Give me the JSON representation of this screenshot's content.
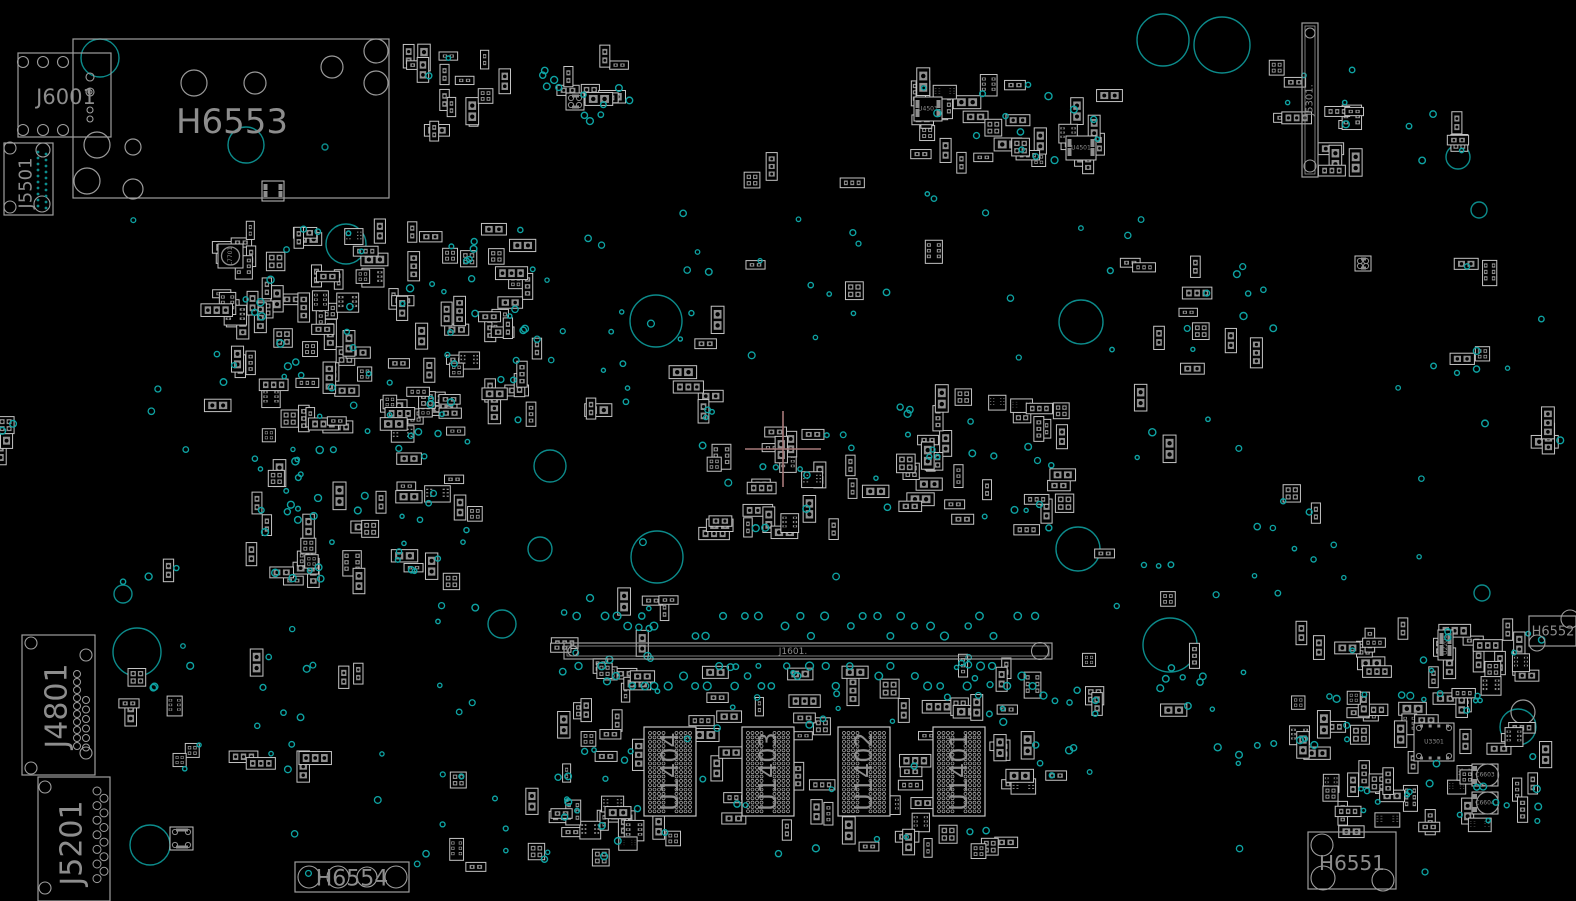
{
  "colors": {
    "background": "#000000",
    "silk_text": "#8d8d8d",
    "box_outline": "#9e9e9e",
    "part_outline": "#c4c4c4",
    "pad_fill": "#8f8f8f",
    "via": "#0ea3a3",
    "big_circle": "#0c8b8b",
    "gray_circle": "#9a9a9a",
    "ball": "#b0b0b0",
    "crosshair": "#a87a7a"
  },
  "board": {
    "width": 1576,
    "height": 901,
    "majors": [
      {
        "id": "H6553",
        "label": "H6553",
        "x": 73,
        "y": 39,
        "w": 316,
        "h": 159,
        "font": 34,
        "lx": 232,
        "ly": 122,
        "rot": 0
      },
      {
        "id": "J6001",
        "label": "J6001",
        "x": 18,
        "y": 53,
        "w": 93,
        "h": 84,
        "font": 21,
        "lx": 66,
        "ly": 97,
        "rot": 0,
        "pins": [
          [
            23,
            62,
            5.5
          ],
          [
            43,
            62,
            5.5
          ],
          [
            63,
            62,
            5.5
          ],
          [
            23,
            130,
            5.5
          ],
          [
            43,
            130,
            5.5
          ],
          [
            63,
            130,
            5.5
          ],
          [
            90,
            77,
            4
          ],
          [
            90,
            92,
            4
          ],
          [
            90,
            92,
            2
          ],
          [
            90,
            110,
            3
          ],
          [
            90,
            119,
            3
          ]
        ]
      },
      {
        "id": "J5501",
        "label": "J5501",
        "x": 4,
        "y": 143,
        "w": 49,
        "h": 72,
        "font": 18,
        "lx": 26,
        "ly": 183,
        "rot": -90,
        "pins": [
          [
            10,
            148,
            6
          ],
          [
            43,
            150,
            7
          ],
          [
            10,
            207,
            6
          ],
          [
            42,
            204,
            8
          ]
        ],
        "dotcols": [
          {
            "x": 38,
            "y0": 152,
            "n": 10,
            "dy": 6
          },
          {
            "x": 46,
            "y0": 154,
            "n": 10,
            "dy": 6
          }
        ]
      },
      {
        "id": "J4801",
        "label": "J4801",
        "x": 22,
        "y": 635,
        "w": 73,
        "h": 140,
        "font": 30,
        "lx": 57,
        "ly": 706,
        "rot": -90,
        "pins": [
          [
            31,
            643,
            6
          ],
          [
            86,
            655,
            6
          ],
          [
            31,
            768,
            6
          ],
          [
            86,
            753,
            6
          ]
        ],
        "pincols": [
          {
            "x": 77,
            "y0": 674,
            "n": 10,
            "dy": 8,
            "r": 3.5
          },
          {
            "x": 86,
            "y0": 700,
            "n": 6,
            "dy": 9.5,
            "r": 3.5
          }
        ]
      },
      {
        "id": "J5201",
        "label": "J5201",
        "x": 38,
        "y": 777,
        "w": 72,
        "h": 124,
        "font": 30,
        "lx": 72,
        "ly": 843,
        "rot": -90,
        "pins": [
          [
            45,
            787,
            6
          ],
          [
            45,
            888,
            6
          ]
        ],
        "zigzag": {
          "x1": 97,
          "x2": 104,
          "y0": 791,
          "n": 13,
          "dy": 7.3,
          "r": 4
        }
      },
      {
        "id": "H6554",
        "label": "H6554",
        "x": 295,
        "y": 862,
        "w": 114,
        "h": 30,
        "font": 22,
        "lx": 352,
        "ly": 879,
        "rot": 0,
        "pins": [
          [
            309,
            877,
            11
          ],
          [
            338,
            877,
            11
          ],
          [
            367,
            877,
            10
          ],
          [
            396,
            877,
            11
          ]
        ]
      },
      {
        "id": "H6551",
        "label": "H6551",
        "x": 1308,
        "y": 832,
        "w": 88,
        "h": 57,
        "font": 20,
        "lx": 1352,
        "ly": 863,
        "rot": 0,
        "pins": [
          [
            1322,
            845,
            11
          ],
          [
            1323,
            878,
            12
          ],
          [
            1383,
            880,
            11
          ]
        ]
      },
      {
        "id": "H6552",
        "label": "H6552",
        "x": 1529,
        "y": 616,
        "w": 47,
        "h": 30,
        "font": 13,
        "lx": 1553,
        "ly": 632,
        "rot": 0,
        "pins": [
          [
            1537,
            643,
            8
          ],
          [
            1570,
            619,
            9
          ]
        ]
      },
      {
        "id": "J5301",
        "label": "J5301.",
        "x": 1302,
        "y": 23,
        "w": 16,
        "h": 154,
        "font": 10,
        "lx": 1310,
        "ly": 100,
        "rot": -90,
        "inner": true,
        "pins": [
          [
            1310,
            33,
            5
          ],
          [
            1310,
            166,
            6
          ]
        ]
      },
      {
        "id": "J1601",
        "label": "J1601.",
        "x": 564,
        "y": 643,
        "w": 488,
        "h": 16,
        "font": 9,
        "lx": 793,
        "ly": 652,
        "rot": 0,
        "slot": true,
        "pins": [
          [
            573,
            651,
            5
          ],
          [
            1040,
            651,
            8.5
          ]
        ]
      }
    ],
    "chips": {
      "lefts": [
        644,
        742,
        838,
        933
      ],
      "top": 727,
      "w": 52,
      "h": 89,
      "font": 24,
      "labels": [
        "U1404",
        "U1403",
        "U1402",
        "U1401"
      ]
    },
    "named_parts": [
      {
        "label": "U4503",
        "x": 914,
        "y": 97,
        "w": 28,
        "h": 24,
        "rot": 0,
        "type": "ic"
      },
      {
        "label": "U4501",
        "x": 1066,
        "y": 136,
        "w": 30,
        "h": 24,
        "rot": 0,
        "type": "ic"
      },
      {
        "label": "U2201",
        "x": 1438,
        "y": 630,
        "w": 15,
        "h": 30,
        "rot": -90,
        "type": "ic"
      },
      {
        "label": "U3301",
        "x": 1414,
        "y": 723,
        "w": 40,
        "h": 38,
        "rot": 0,
        "type": "qfn"
      },
      {
        "label": "C6603",
        "x": 1472,
        "y": 764,
        "w": 26,
        "h": 22,
        "rot": 0,
        "type": "cap"
      },
      {
        "label": "C6604",
        "x": 1472,
        "y": 792,
        "w": 26,
        "h": 22,
        "rot": 0,
        "type": "cap"
      },
      {
        "label": "L7701",
        "x": 218,
        "y": 244,
        "w": 25,
        "h": 24,
        "rot": -90,
        "type": "coil"
      },
      {
        "label": "",
        "x": 262,
        "y": 181,
        "w": 22,
        "h": 20,
        "rot": 0,
        "type": "ic"
      },
      {
        "label": "",
        "x": 170,
        "y": 827,
        "w": 23,
        "h": 23,
        "rot": 0,
        "type": "qfn"
      },
      {
        "label": "",
        "x": 566,
        "y": 93,
        "w": 18,
        "h": 17,
        "rot": 0,
        "type": "qfn"
      },
      {
        "label": "",
        "x": 1355,
        "y": 256,
        "w": 16,
        "h": 15,
        "rot": 0,
        "type": "qfn"
      }
    ],
    "crosshair": {
      "x": 783,
      "y": 449,
      "arm": 38
    },
    "big_circles": [
      [
        100,
        58,
        19
      ],
      [
        246,
        145,
        18
      ],
      [
        1163,
        40,
        26
      ],
      [
        1222,
        45,
        28
      ],
      [
        1458,
        157,
        12
      ],
      [
        1479,
        210,
        8
      ],
      [
        346,
        244,
        20
      ],
      [
        656,
        321,
        26
      ],
      [
        1081,
        322,
        22
      ],
      [
        550,
        466,
        16
      ],
      [
        540,
        549,
        12
      ],
      [
        657,
        557,
        26
      ],
      [
        1078,
        549,
        22
      ],
      [
        123,
        594,
        9
      ],
      [
        502,
        624,
        14
      ],
      [
        1482,
        593,
        8
      ],
      [
        137,
        652,
        24
      ],
      [
        1170,
        645,
        27
      ],
      [
        150,
        845,
        20
      ],
      [
        1518,
        727,
        18
      ],
      [
        1437,
        743,
        13
      ],
      [
        325,
        147,
        3
      ]
    ],
    "gray_circles": [
      [
        194,
        83,
        13
      ],
      [
        255,
        83,
        11
      ],
      [
        332,
        67,
        11
      ],
      [
        376,
        51,
        12
      ],
      [
        376,
        83,
        12
      ],
      [
        97,
        145,
        13
      ],
      [
        133,
        147,
        8
      ],
      [
        87,
        181,
        13
      ],
      [
        133,
        189,
        10
      ],
      [
        1523,
        712,
        12
      ]
    ],
    "clusters": [
      {
        "id": "top-left-bank",
        "x": 408,
        "y": 48,
        "w": 100,
        "h": 90,
        "parts": 16,
        "vias": 2
      },
      {
        "id": "top-center",
        "x": 538,
        "y": 52,
        "w": 92,
        "h": 72,
        "parts": 8,
        "vias": 12
      },
      {
        "id": "top-right-bank",
        "x": 905,
        "y": 80,
        "w": 205,
        "h": 92,
        "parts": 32,
        "vias": 14
      },
      {
        "id": "right-edge-top-a",
        "x": 1262,
        "y": 58,
        "w": 42,
        "h": 60,
        "parts": 4,
        "vias": 2
      },
      {
        "id": "right-edge-top-b",
        "x": 1330,
        "y": 62,
        "w": 30,
        "h": 118,
        "parts": 8,
        "vias": 3
      },
      {
        "id": "left-main",
        "x": 214,
        "y": 228,
        "w": 324,
        "h": 208,
        "parts": 112,
        "vias": 55
      },
      {
        "id": "left-lower",
        "x": 250,
        "y": 448,
        "w": 190,
        "h": 135,
        "parts": 24,
        "vias": 34
      },
      {
        "id": "center-main",
        "x": 700,
        "y": 396,
        "w": 368,
        "h": 142,
        "parts": 58,
        "vias": 30
      },
      {
        "id": "center-right-sparse",
        "x": 1100,
        "y": 255,
        "w": 175,
        "h": 225,
        "parts": 12,
        "vias": 12
      },
      {
        "id": "slot-left",
        "x": 552,
        "y": 598,
        "w": 118,
        "h": 100,
        "parts": 14,
        "vias": 10
      },
      {
        "id": "slot-below",
        "x": 690,
        "y": 662,
        "w": 370,
        "h": 36,
        "parts": 10,
        "vias": 10
      },
      {
        "id": "ram-gap-1",
        "x": 698,
        "y": 712,
        "w": 42,
        "h": 112,
        "parts": 7,
        "vias": 2
      },
      {
        "id": "ram-gap-2",
        "x": 796,
        "y": 712,
        "w": 40,
        "h": 112,
        "parts": 7,
        "vias": 2
      },
      {
        "id": "ram-gap-3",
        "x": 892,
        "y": 712,
        "w": 39,
        "h": 112,
        "parts": 7,
        "vias": 2
      },
      {
        "id": "ram-gap-4",
        "x": 987,
        "y": 712,
        "w": 45,
        "h": 112,
        "parts": 7,
        "vias": 2
      },
      {
        "id": "ram-top-row",
        "x": 640,
        "y": 698,
        "w": 372,
        "h": 15,
        "parts": 9,
        "vias": 2
      },
      {
        "id": "ram-bottom-row",
        "x": 640,
        "y": 826,
        "w": 380,
        "h": 32,
        "parts": 12,
        "vias": 6
      },
      {
        "id": "ram-left-bank",
        "x": 552,
        "y": 700,
        "w": 90,
        "h": 158,
        "parts": 22,
        "vias": 12
      },
      {
        "id": "bottom-left-sparse",
        "x": 112,
        "y": 655,
        "w": 195,
        "h": 115,
        "parts": 10,
        "vias": 12
      },
      {
        "id": "bottom-right-main",
        "x": 1298,
        "y": 628,
        "w": 248,
        "h": 204,
        "parts": 74,
        "vias": 40
      },
      {
        "id": "mid-sparse-a",
        "x": 580,
        "y": 328,
        "w": 148,
        "h": 108,
        "parts": 5,
        "vias": 6
      },
      {
        "id": "mid-sparse-b",
        "x": 680,
        "y": 162,
        "w": 288,
        "h": 158,
        "parts": 7,
        "vias": 10
      },
      {
        "id": "mid-sparse-c",
        "x": 405,
        "y": 440,
        "w": 75,
        "h": 200,
        "parts": 6,
        "vias": 8
      },
      {
        "id": "bottom-center-sparse",
        "x": 420,
        "y": 772,
        "w": 150,
        "h": 115,
        "parts": 6,
        "vias": 10
      },
      {
        "id": "right-top-sparse",
        "x": 1380,
        "y": 82,
        "w": 92,
        "h": 86,
        "parts": 3,
        "vias": 4
      },
      {
        "id": "right-mid-sparse",
        "x": 1430,
        "y": 252,
        "w": 128,
        "h": 198,
        "parts": 5,
        "vias": 6
      },
      {
        "id": "right-edge-pair",
        "x": 1545,
        "y": 420,
        "w": 31,
        "h": 28,
        "parts": 2,
        "vias": 1
      },
      {
        "id": "center-low-sparse",
        "x": 1095,
        "y": 552,
        "w": 80,
        "h": 68,
        "parts": 2,
        "vias": 4
      },
      {
        "id": "left-edge-mid",
        "x": 0,
        "y": 408,
        "w": 16,
        "h": 58,
        "parts": 3,
        "vias": 2
      },
      {
        "id": "left-mid-sparse",
        "x": 100,
        "y": 560,
        "w": 85,
        "h": 58,
        "parts": 1,
        "vias": 3
      },
      {
        "id": "right-center-sparse",
        "x": 1240,
        "y": 482,
        "w": 78,
        "h": 98,
        "parts": 2,
        "vias": 5
      },
      {
        "id": "slot-right-below",
        "x": 1040,
        "y": 658,
        "w": 70,
        "h": 56,
        "parts": 3,
        "vias": 6
      },
      {
        "id": "circle-right-vias",
        "x": 1160,
        "y": 642,
        "w": 100,
        "h": 76,
        "parts": 2,
        "vias": 8
      },
      {
        "id": "bottom-mid-vias",
        "x": 1200,
        "y": 730,
        "w": 80,
        "h": 40,
        "parts": 0,
        "vias": 5
      },
      {
        "id": "ram-right-vias",
        "x": 1030,
        "y": 730,
        "w": 50,
        "h": 60,
        "parts": 1,
        "vias": 5
      },
      {
        "id": "single-a",
        "x": 288,
        "y": 758,
        "w": 30,
        "h": 22,
        "parts": 1,
        "vias": 0
      },
      {
        "id": "single-b",
        "x": 342,
        "y": 666,
        "w": 40,
        "h": 20,
        "parts": 2,
        "vias": 0
      }
    ],
    "slot_vias": {
      "x0": 578,
      "x1": 1042,
      "step": 13,
      "rows_above": [
        616,
        626,
        636
      ],
      "rows_below": [
        666,
        676,
        686
      ]
    },
    "scatter_vias": {
      "count": 85,
      "x0": 120,
      "y0": 205,
      "x1": 1520,
      "y1": 875
    }
  }
}
